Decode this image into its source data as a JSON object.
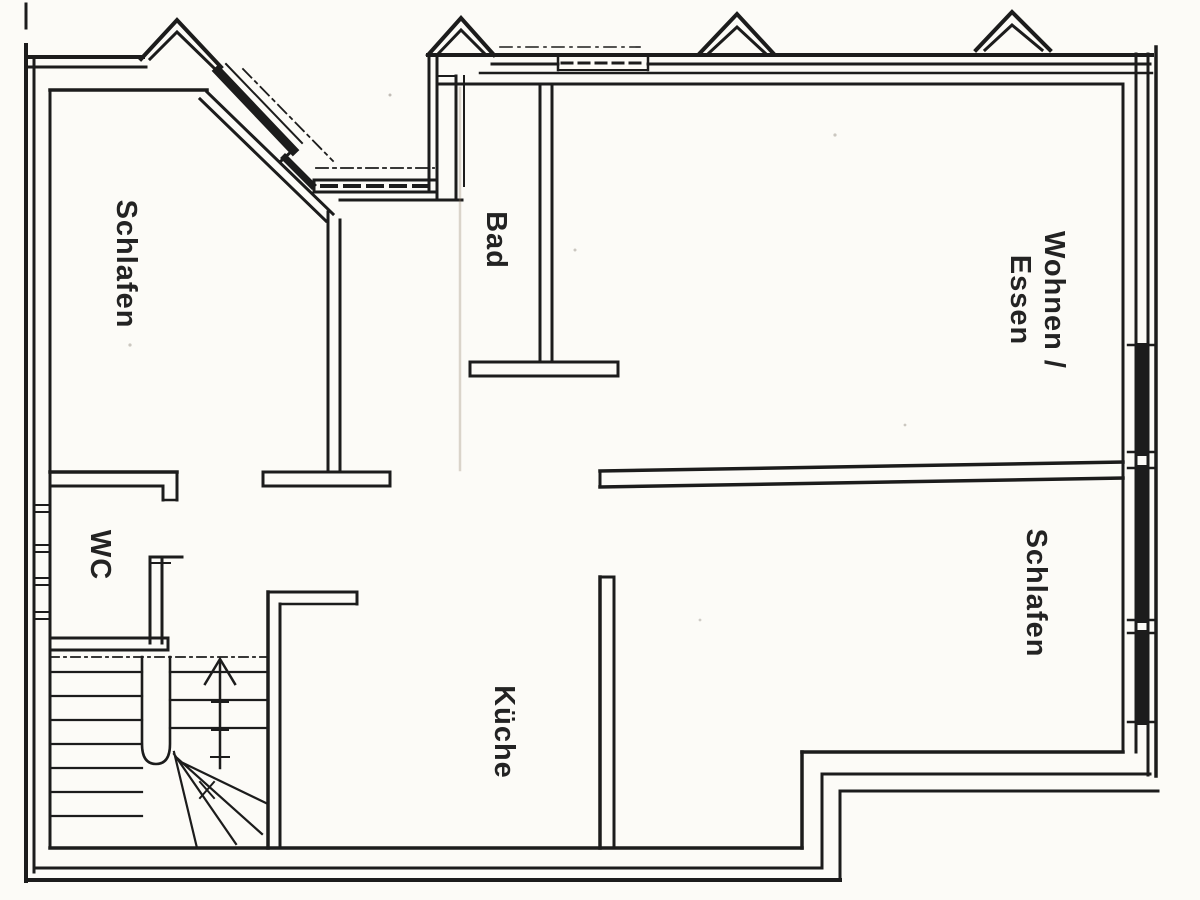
{
  "document": {
    "kind": "scanned floor plan",
    "paper_color": "#fcfbf7",
    "ink_color": "#1c1c1c",
    "fold_smudge_color": "#8c7a62"
  },
  "rooms": [
    {
      "id": "schlafen-left",
      "label": "Schlafen",
      "rotation_deg": 90
    },
    {
      "id": "bad",
      "label": "Bad",
      "rotation_deg": 90
    },
    {
      "id": "wohnen-essen",
      "label_line1": "Wohnen /",
      "label_line2": "Essen",
      "rotation_deg": 90
    },
    {
      "id": "schlafen-right",
      "label": "Schlafen",
      "rotation_deg": 90
    },
    {
      "id": "wc",
      "label": "WC",
      "rotation_deg": 90
    },
    {
      "id": "kueche",
      "label": "Küche",
      "rotation_deg": 90
    }
  ],
  "stairs": {
    "direction_arrow": "up",
    "flights": 2,
    "winder_steps": true
  },
  "features": {
    "gable_dormers": 4,
    "window_bands_right_wall": 3,
    "canted_bay_top_left": true
  }
}
